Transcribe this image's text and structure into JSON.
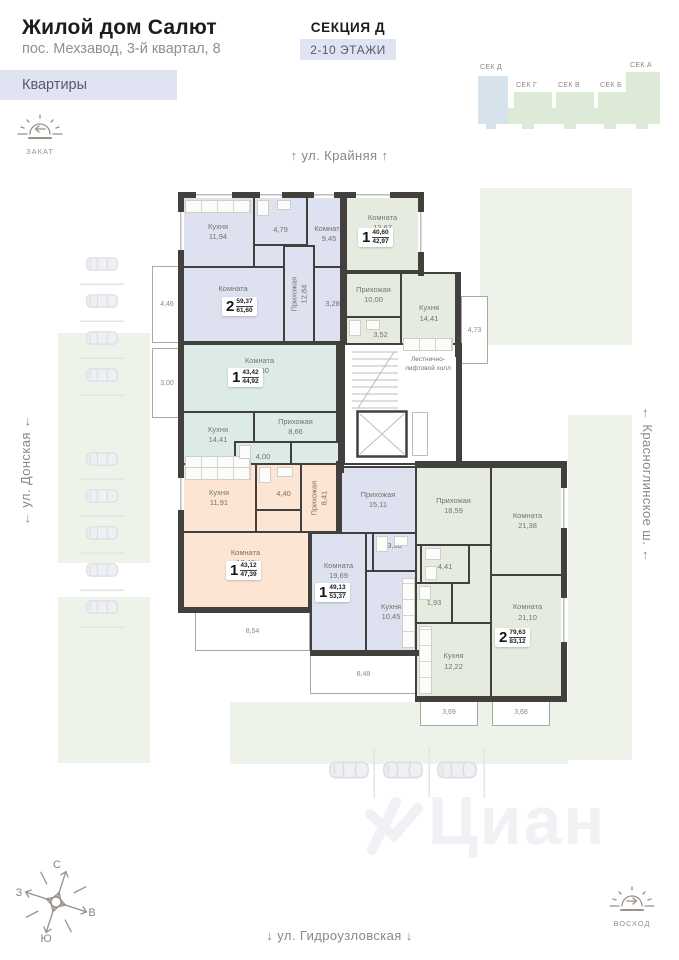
{
  "header": {
    "title": "Жилой дом Салют",
    "subtitle": "пос. Мехзавод, 3-й квартал, 8",
    "tab": "Квартиры",
    "section": "СЕКЦИЯ Д",
    "floors": "2-10 ЭТАЖИ"
  },
  "minimap": {
    "sections": [
      {
        "label": "СЕК Д",
        "active": true
      },
      {
        "label": "СЕК Г",
        "active": false
      },
      {
        "label": "СЕК В",
        "active": false
      },
      {
        "label": "СЕК Б",
        "active": false
      },
      {
        "label": "СЕК А",
        "active": false
      }
    ]
  },
  "sun": {
    "sunset": "ЗАКАТ",
    "sunrise": "ВОСХОД"
  },
  "streets": {
    "top": "ул. Крайняя",
    "left": "ул. Донская",
    "right": "Красноглинское ш.",
    "bottom": "ул. Гидроузловская",
    "arrow_up": "↑",
    "arrow_down": "↓",
    "arrow_side": "←"
  },
  "compass": {
    "n": "С",
    "s": "Ю",
    "w": "З",
    "e": "В"
  },
  "plan": {
    "stairs": "Лестнично-лифтовой холл"
  },
  "apartments": {
    "a1": {
      "num": "2",
      "top": "59,37",
      "bot": "61,60",
      "kitchen": {
        "n": "Кухня",
        "a": "11,94"
      },
      "bath": {
        "a": "4,79"
      },
      "bedroom": {
        "n": "Комната",
        "a": "9,45"
      },
      "living": {
        "n": "Комната",
        "a": "17,07"
      },
      "hall": {
        "n": "Прихожая",
        "a": "12,84"
      },
      "wc": {
        "a": "3,28"
      },
      "balcony": {
        "a": "4,46"
      }
    },
    "a2": {
      "num": "1",
      "top": "40,60",
      "bot": "42,97",
      "room": {
        "n": "Комната",
        "a": "12,67"
      },
      "hall": {
        "n": "Прихожая",
        "a": "10,00"
      },
      "kitchen": {
        "n": "Кухня",
        "a": "14,41"
      },
      "bath": {
        "a": "3,52"
      },
      "balcony": {
        "a": "4,73"
      }
    },
    "a3": {
      "num": "1",
      "top": "43,42",
      "bot": "44,92",
      "room": {
        "n": "Комната",
        "a": "20,30"
      },
      "kitchen": {
        "n": "Кухня",
        "a": "14,41"
      },
      "hall": {
        "n": "Прихожая",
        "a": "8,66"
      },
      "bath": {
        "a": "4,00"
      },
      "balcony": {
        "a": "3,00"
      }
    },
    "a4": {
      "num": "1",
      "top": "43,12",
      "bot": "47,39",
      "kitchen": {
        "n": "Кухня",
        "a": "11,91"
      },
      "bath": {
        "a": "4,40"
      },
      "hall": {
        "n": "Прихожая",
        "a": "8,41"
      },
      "room": {
        "n": "Комната",
        "a": "18,40"
      },
      "balcony": {
        "a": "8,54"
      }
    },
    "a5": {
      "num": "1",
      "top": "49,13",
      "bot": "53,37",
      "hall": {
        "n": "Прихожая",
        "a": "15,11"
      },
      "bath": {
        "a": "3,88"
      },
      "room": {
        "n": "Комната",
        "a": "19,69"
      },
      "kitchen": {
        "n": "Кухня",
        "a": "10,45"
      },
      "balcony": {
        "a": "8,48"
      }
    },
    "a6": {
      "num": "2",
      "top": "79,63",
      "bot": "83,12",
      "hall": {
        "n": "Прихожая",
        "a": "18,59"
      },
      "room1": {
        "n": "Комната",
        "a": "21,38"
      },
      "bath": {
        "a": "4,41"
      },
      "wc": {
        "a": "1,93"
      },
      "kitchen": {
        "n": "Кухня",
        "a": "12,22"
      },
      "room2": {
        "n": "Комната",
        "a": "21,10"
      },
      "balcony1": {
        "a": "3,69"
      },
      "balcony2": {
        "a": "3,68"
      }
    }
  },
  "watermark": {
    "text": "Циан"
  },
  "colors": {
    "apartment_blue": "#dde1f0",
    "apartment_green": "#e5ecdf",
    "apartment_teal": "#dcebe8",
    "apartment_peach": "#fce5d3",
    "landscape": "#edf3e8",
    "accent_bg": "#e0e4f2",
    "wall": "#41403d",
    "minimap_active": "#d7e3ec",
    "minimap_normal": "#dcead7"
  }
}
